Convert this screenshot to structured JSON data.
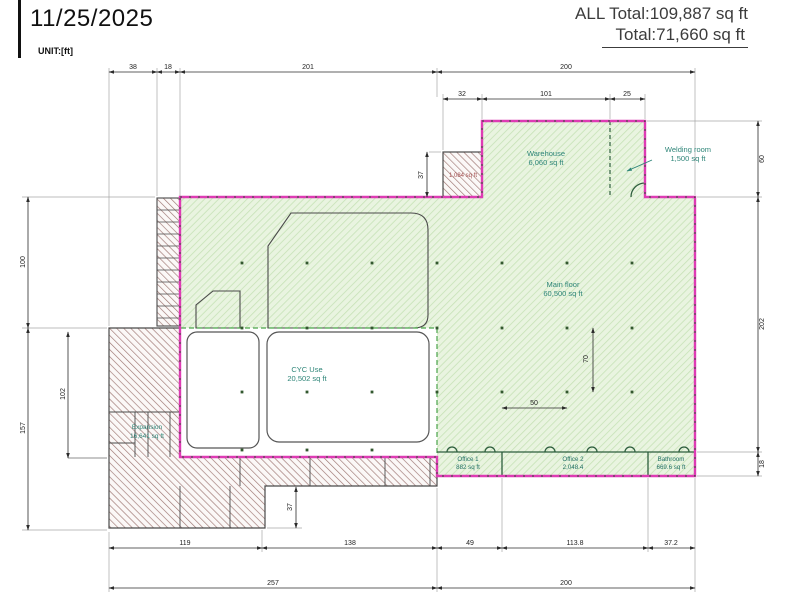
{
  "header": {
    "date": "11/25/2025",
    "unit": "UNIT:[ft]",
    "all_total": "ALL Total:109,887 sq ft",
    "total": "Total:71,660 sq ft"
  },
  "rooms": {
    "warehouse": {
      "name": "Warehouse",
      "area": "6,060 sq ft"
    },
    "welding_room": {
      "name": "Welding room",
      "area": "1,500 sq ft"
    },
    "main_floor": {
      "name": "Main floor",
      "area": "60,500 sq ft"
    },
    "cyc_use": {
      "name": "CYC Use",
      "area": "20,502 sq ft"
    },
    "office_1": {
      "name": "Office 1",
      "area": "882 sq ft"
    },
    "office_2": {
      "name": "Office 2",
      "area": "2,048.4"
    },
    "bathroom": {
      "name": "Bathroom",
      "area": "669.6 sq ft"
    },
    "expansion": {
      "name": "Expansion",
      "area": "16,641 sq ft"
    },
    "existing_block": {
      "area": "1,084 sq ft"
    }
  },
  "dimensions": {
    "top": [
      "38",
      "18",
      "201",
      "200"
    ],
    "warehouse_top": [
      "32",
      "101",
      "25"
    ],
    "right": [
      "60",
      "202",
      "18"
    ],
    "left": [
      "100",
      "157"
    ],
    "left_inner": "102",
    "warehouse_height": "37",
    "step_height": "37",
    "column_offset": "70",
    "column_spacing": "50",
    "bottom": [
      "119",
      "138",
      "49",
      "113.8",
      "37.2"
    ],
    "bottom_overall": [
      "257",
      "200"
    ]
  },
  "colors": {
    "boundary_magenta": "#de3bb4",
    "zone_green_fill": "#e9f4e0",
    "zone_green_hatch": "#c6e2b6",
    "existing_hatch": "#9d7672",
    "room_label_teal": "#2e8578",
    "dimension_ink": "#1f1f1f"
  }
}
